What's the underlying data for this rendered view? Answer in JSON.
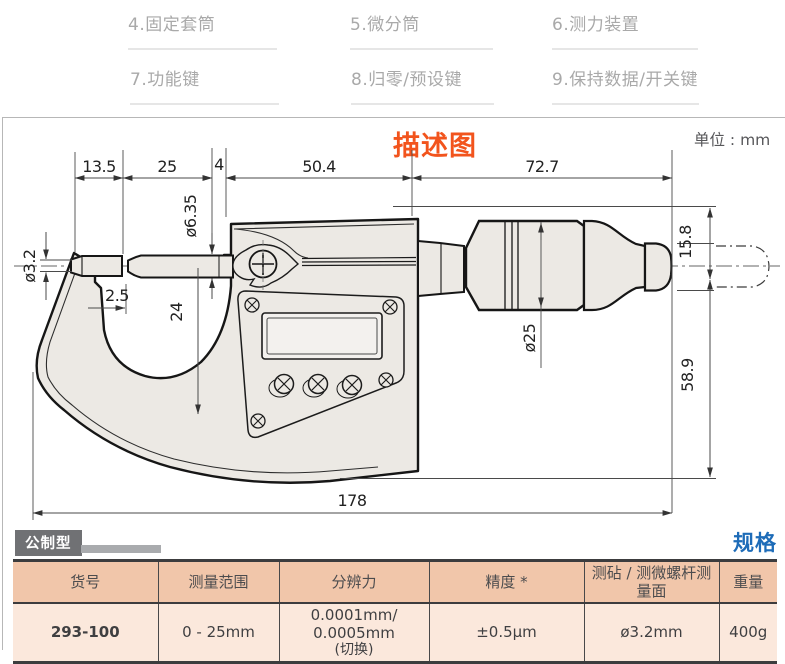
{
  "parts_labels": [
    "4.固定套筒",
    "5.微分筒",
    "6.测力装置",
    "7.功能键",
    "8.归零/预设键",
    "9.保持数据/开关键"
  ],
  "diagram": {
    "title": "描述图",
    "unit_label": "单位 : mm",
    "dims": {
      "seg1": "13.5",
      "seg2": "25",
      "seg3": "4",
      "seg4": "50.4",
      "seg5": "72.7",
      "anvil_dia": "ø3.2",
      "spindle_dia": "ø6.35",
      "tip_gap": "2.5",
      "throat_depth": "24",
      "ratchet_dia": "15.8",
      "thimble_dia": "ø25",
      "body_height": "58.9",
      "total_length": "178"
    }
  },
  "spec": {
    "type_badge": "公制型",
    "section_title": "规格",
    "table": {
      "headers": [
        "货号",
        "测量范围",
        "分辨力",
        "精度 *",
        "测砧 / 测微螺杆测量面",
        "重量"
      ],
      "row": {
        "code": "293-100",
        "range": "0 - 25mm",
        "resolution_line1": "0.0001mm/ 0.0005mm",
        "resolution_line2": "(切换)",
        "accuracy": "±0.5μm",
        "face": "ø3.2mm",
        "weight": "400g"
      }
    }
  },
  "colors": {
    "accent_orange": "#f2541d",
    "accent_blue": "#1e6cb8",
    "table_header_bg": "#f1c6aa",
    "table_row_bg": "#fbe8dc",
    "part_fill": "#ece9e4"
  }
}
